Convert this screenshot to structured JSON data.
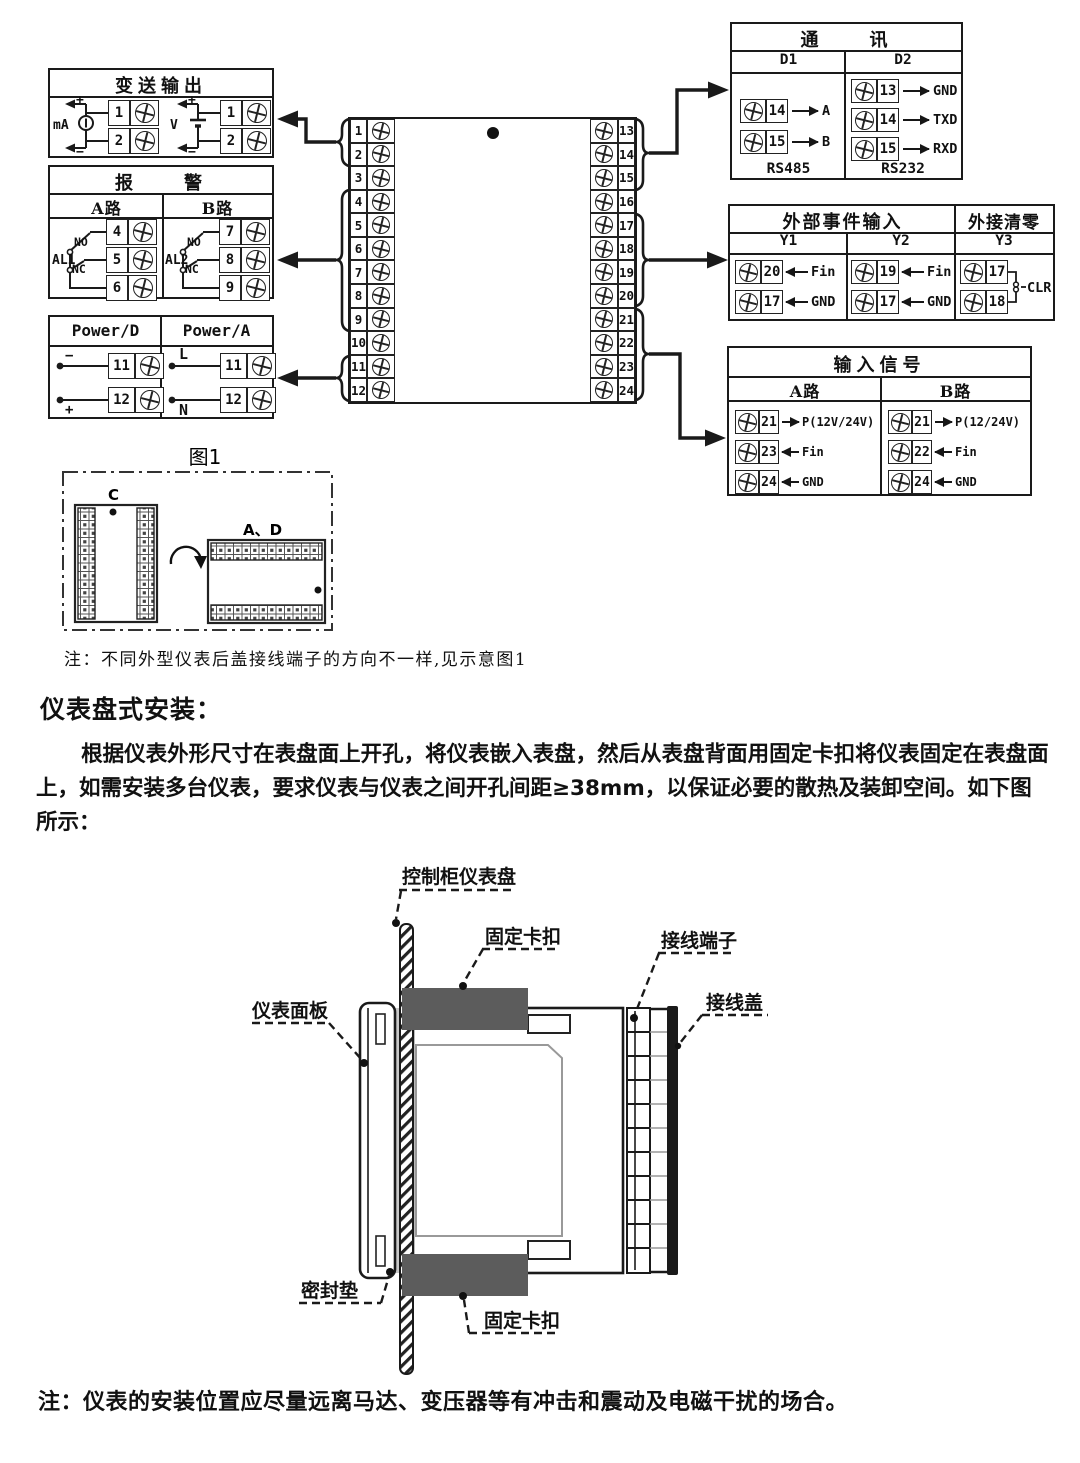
{
  "wiring": {
    "transmitter": {
      "title": "变送输出",
      "plus": "+",
      "minus": "−",
      "ma_label": "mA",
      "v_label": "V",
      "ma_terminals": [
        "1",
        "2"
      ],
      "v_terminals": [
        "1",
        "2"
      ]
    },
    "alarm": {
      "title": "报　　警",
      "col_a": "A路",
      "col_b": "B路",
      "a_relay": "AL1",
      "b_relay": "AL2",
      "no": "NO",
      "nc": "NC",
      "a_terminals": [
        "4",
        "5",
        "6"
      ],
      "b_terminals": [
        "7",
        "8",
        "9"
      ]
    },
    "power": {
      "col_d": "Power/D",
      "col_a": "Power/A",
      "d_rows": [
        {
          "sign": "−",
          "num": "11"
        },
        {
          "sign": "+",
          "num": "12"
        }
      ],
      "a_rows": [
        {
          "sign": "L",
          "num": "11"
        },
        {
          "sign": "N",
          "num": "12"
        }
      ]
    },
    "center": {
      "left": [
        "1",
        "2",
        "3",
        "4",
        "5",
        "6",
        "7",
        "8",
        "9",
        "10",
        "11",
        "12"
      ],
      "right": [
        "13",
        "14",
        "15",
        "16",
        "17",
        "18",
        "19",
        "20",
        "21",
        "22",
        "23",
        "24"
      ]
    },
    "comm": {
      "title": "通　　讯",
      "col1": "D1",
      "col2": "D2",
      "d1_rows": [
        {
          "num": "14",
          "dir": "→",
          "label": "A"
        },
        {
          "num": "15",
          "dir": "→",
          "label": "B"
        }
      ],
      "d2_rows": [
        {
          "num": "13",
          "dir": "→",
          "label": "GND"
        },
        {
          "num": "14",
          "dir": "→",
          "label": "TXD"
        },
        {
          "num": "15",
          "dir": "→",
          "label": "RXD"
        }
      ],
      "d1_footer": "RS485",
      "d2_footer": "RS232"
    },
    "event": {
      "title": "外部事件输入",
      "title2": "外接清零",
      "col1": "Y1",
      "col2": "Y2",
      "col3": "Y3",
      "y1_rows": [
        {
          "num": "20",
          "dir": "←",
          "label": "Fin"
        },
        {
          "num": "17",
          "dir": "←",
          "label": "GND"
        }
      ],
      "y2_rows": [
        {
          "num": "19",
          "dir": "←",
          "label": "Fin"
        },
        {
          "num": "17",
          "dir": "←",
          "label": "GND"
        }
      ],
      "y3_nums": [
        "17",
        "18"
      ],
      "y3_label": "CLR"
    },
    "input": {
      "title": "输入信号",
      "col1": "A路",
      "col2": "B路",
      "a_rows": [
        {
          "num": "21",
          "dir": "→",
          "label": "P(12V/24V)"
        },
        {
          "num": "23",
          "dir": "←",
          "label": "Fin"
        },
        {
          "num": "24",
          "dir": "←",
          "label": "GND"
        }
      ],
      "b_rows": [
        {
          "num": "21",
          "dir": "→",
          "label": "P(12/24V)"
        },
        {
          "num": "22",
          "dir": "←",
          "label": "Fin"
        },
        {
          "num": "24",
          "dir": "←",
          "label": "GND"
        }
      ]
    },
    "fig1": {
      "caption": "图1",
      "c_label": "C",
      "ad_label": "A、D"
    },
    "note": "注：不同外型仪表后盖接线端子的方向不一样,见示意图1"
  },
  "install": {
    "heading": "仪表盘式安装：",
    "paragraph": "根据仪表外形尺寸在表盘面上开孔，将仪表嵌入表盘，然后从表盘背面用固定卡扣将仪表固定在表盘面上，如需安装多台仪表，要求仪表与仪表之间开孔间距≥38mm，以保证必要的散热及装卸空间。如下图所示：",
    "labels": {
      "panel": "控制柜仪表盘",
      "clip_top": "固定卡扣",
      "terminal": "接线端子",
      "cover": "接线盖",
      "front": "仪表面板",
      "gasket": "密封垫",
      "clip_bottom": "固定卡扣"
    },
    "note": "注：仪表的安装位置应尽量远离马达、变压器等有冲击和震动及电磁干扰的场合。"
  },
  "colors": {
    "line": "#1a1a1a",
    "clip_gray": "#5c5c5c",
    "gasket_gray": "#c9c9c9"
  }
}
